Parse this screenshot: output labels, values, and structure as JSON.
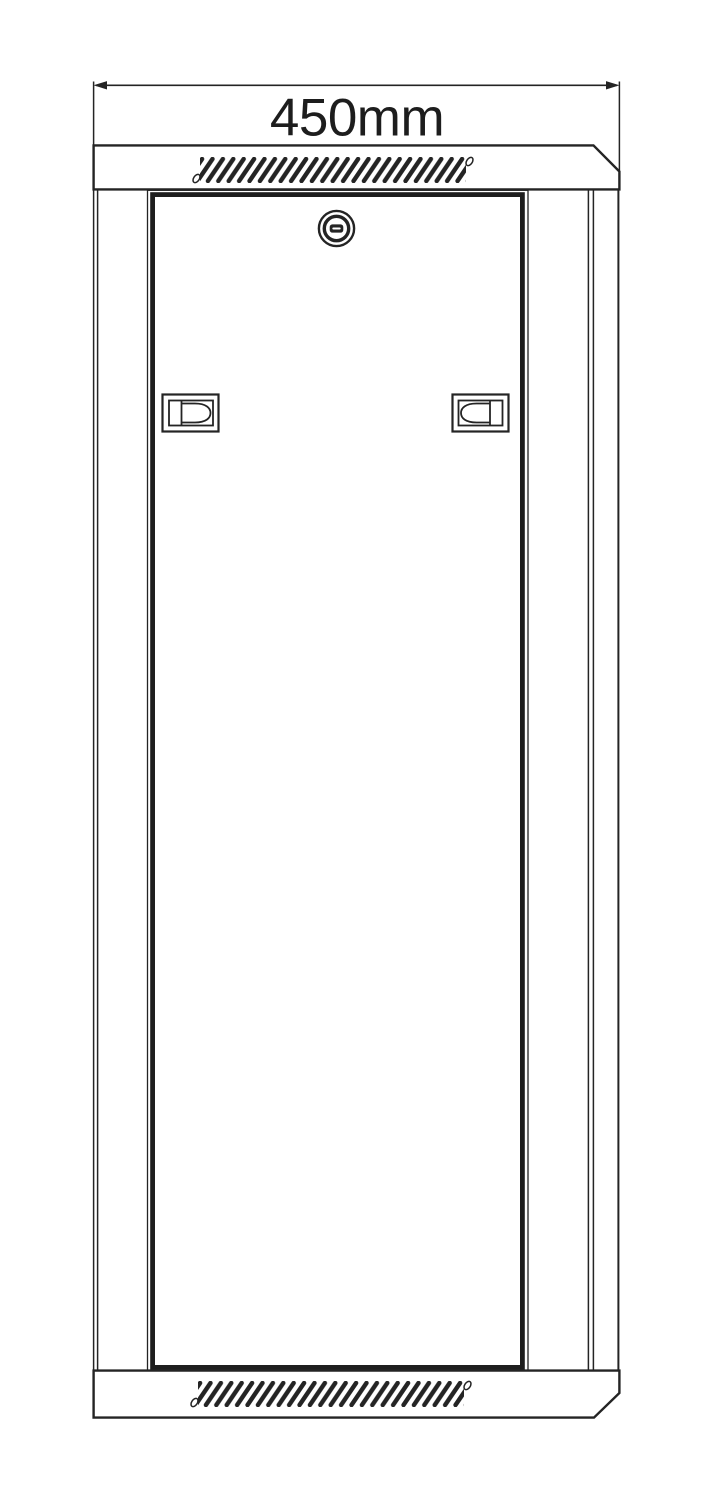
{
  "drawing": {
    "dimension": {
      "label": "450mm"
    }
  },
  "icons": {
    "lock": "cam-lock-icon",
    "left_handle": "door-latch-left",
    "right_handle": "door-latch-right"
  },
  "colors": {
    "line": "#242424",
    "door_line": "#1e1e1e",
    "text": "#1d1d1d",
    "background": "#ffffff"
  }
}
